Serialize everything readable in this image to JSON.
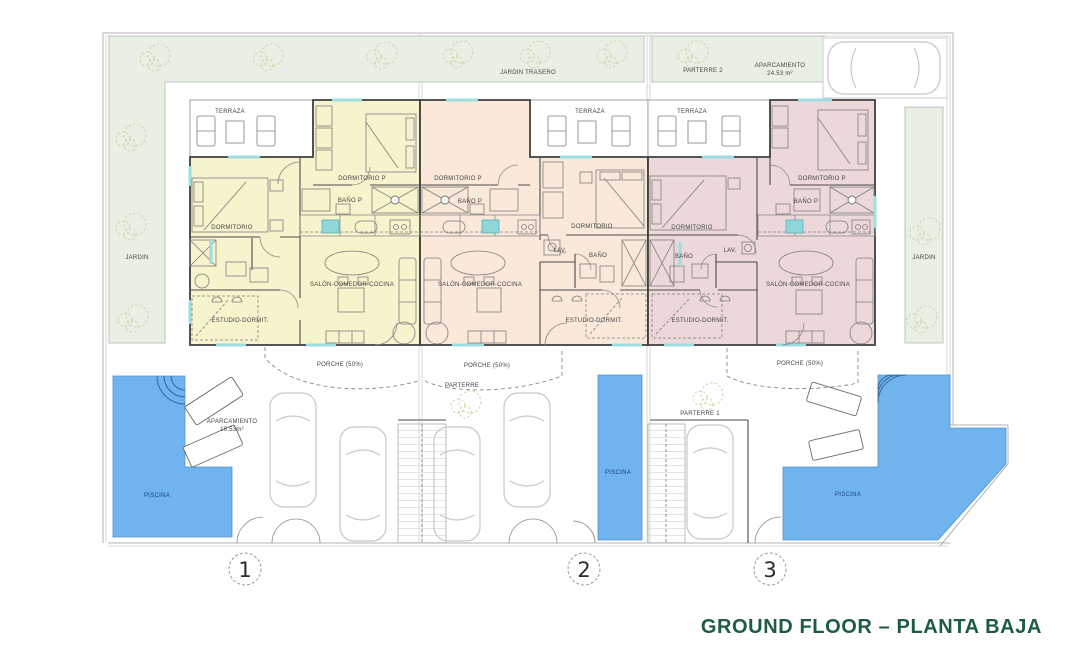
{
  "title": "GROUND FLOOR – PLANTA BAJA",
  "colors": {
    "unit1_fill": "#f7f3cd",
    "unit2_fill": "#fae8d9",
    "unit3_fill": "#ecd8d8",
    "garden_fill": "#e8efe5",
    "pool_fill": "#6fb4ef",
    "title_green": "#1d5b45",
    "window_cyan": "#9ddee2"
  },
  "site": {
    "jardin_trasero": "JARDIN TRASERO",
    "parterre_2": "PARTERRE 2",
    "jardin_left": "JARDIN",
    "jardin_right": "JARDIN",
    "rear_parking_label": "APARCAMIENTO",
    "rear_parking_area": "24.53 m²"
  },
  "units": [
    {
      "number": "1",
      "terraza": "TERRAZA",
      "dormitorio_p": "DORMITORIO P",
      "bano_p": "BAÑO P",
      "dormitorio": "DORMITORIO",
      "salon": "SALÓN-COMEDOR-COCINA",
      "estudio": "ESTUDIO-DORMIT.",
      "porche": "PORCHE (50%)",
      "piscina": "PISCINA",
      "aparcamiento": "APARCAMIENTO",
      "aparcamiento_area": "16.53m²"
    },
    {
      "number": "2",
      "terraza": "TERRAZA",
      "dormitorio_p": "DORMITORIO P",
      "bano_p": "BAÑO P",
      "dormitorio": "DORMITORIO",
      "lav": "LAV.",
      "bano": "BAÑO",
      "salon": "SALÓN-COMEDOR-COCINA",
      "estudio": "ESTUDIO-DORMIT.",
      "porche": "PORCHE (50%)",
      "parterre": "PARTERRE",
      "piscina": "PISCINA"
    },
    {
      "number": "3",
      "terraza": "TERRAZA",
      "dormitorio_p": "DORMITORIO P",
      "bano_p": "BAÑO P",
      "dormitorio": "DORMITORIO",
      "lav": "LAV.",
      "bano": "BAÑO",
      "salon": "SALÓN-COMEDOR-COCINA",
      "estudio": "ESTUDIO-DORMIT.",
      "porche": "PORCHE (50%)",
      "parterre": "PARTERRE 1",
      "piscina": "PISCINA"
    }
  ]
}
